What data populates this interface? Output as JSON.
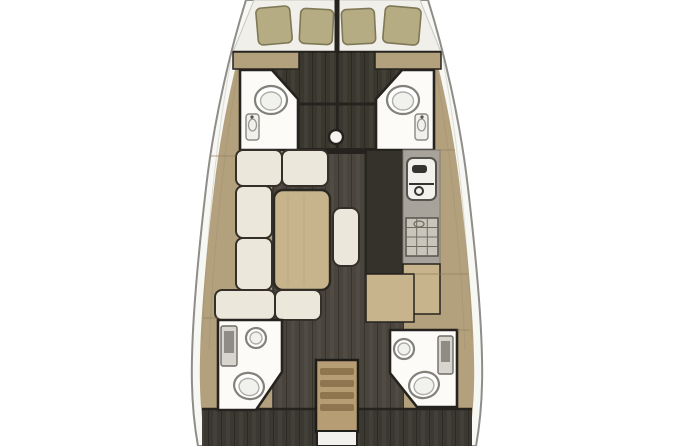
{
  "colors": {
    "bg": "#ffffff",
    "hull-line": "#8e8d89",
    "deck": "#f7f7f4",
    "wood": "#b3a17e",
    "wood-dark": "#8d7c5c",
    "wall": "#26231e",
    "floor-fwd": "#3a372f",
    "floor-salon": "#49453d",
    "floor-aft": "#3b3831",
    "mattress": "#f0efe9",
    "pillow": "#b5ac83",
    "pillow-edge": "#7f7857",
    "cushion": "#ebe8db",
    "cushion-edge": "#343029",
    "table-wood": "#c8b48c",
    "counter": "#a7a39b",
    "appliance": "#f2f1ed",
    "fixture-line": "#82817b",
    "stair": "#b69d73",
    "stair-tread": "#8f7650",
    "head-white": "#fcfbf8"
  },
  "floorplan": {
    "type": "sailing-yacht-interior-plan",
    "view": "top-down",
    "bow": {
      "berths": 2,
      "pillows": 4
    },
    "forward": {
      "cabins": 2,
      "heads": 2,
      "toilets": 2,
      "sinks": 2,
      "mast": 1
    },
    "salon": {
      "sofa_cushions": 8,
      "table": 1,
      "center_bench": 1
    },
    "galley": {
      "sink_unit": 1,
      "stove": 1,
      "counters": 2
    },
    "aft": {
      "cabins": 2,
      "heads": 2,
      "toilets": 2,
      "round_sinks": 2,
      "shower_panels": 2,
      "companionway_steps": 4,
      "engine_hatch": 1
    }
  }
}
